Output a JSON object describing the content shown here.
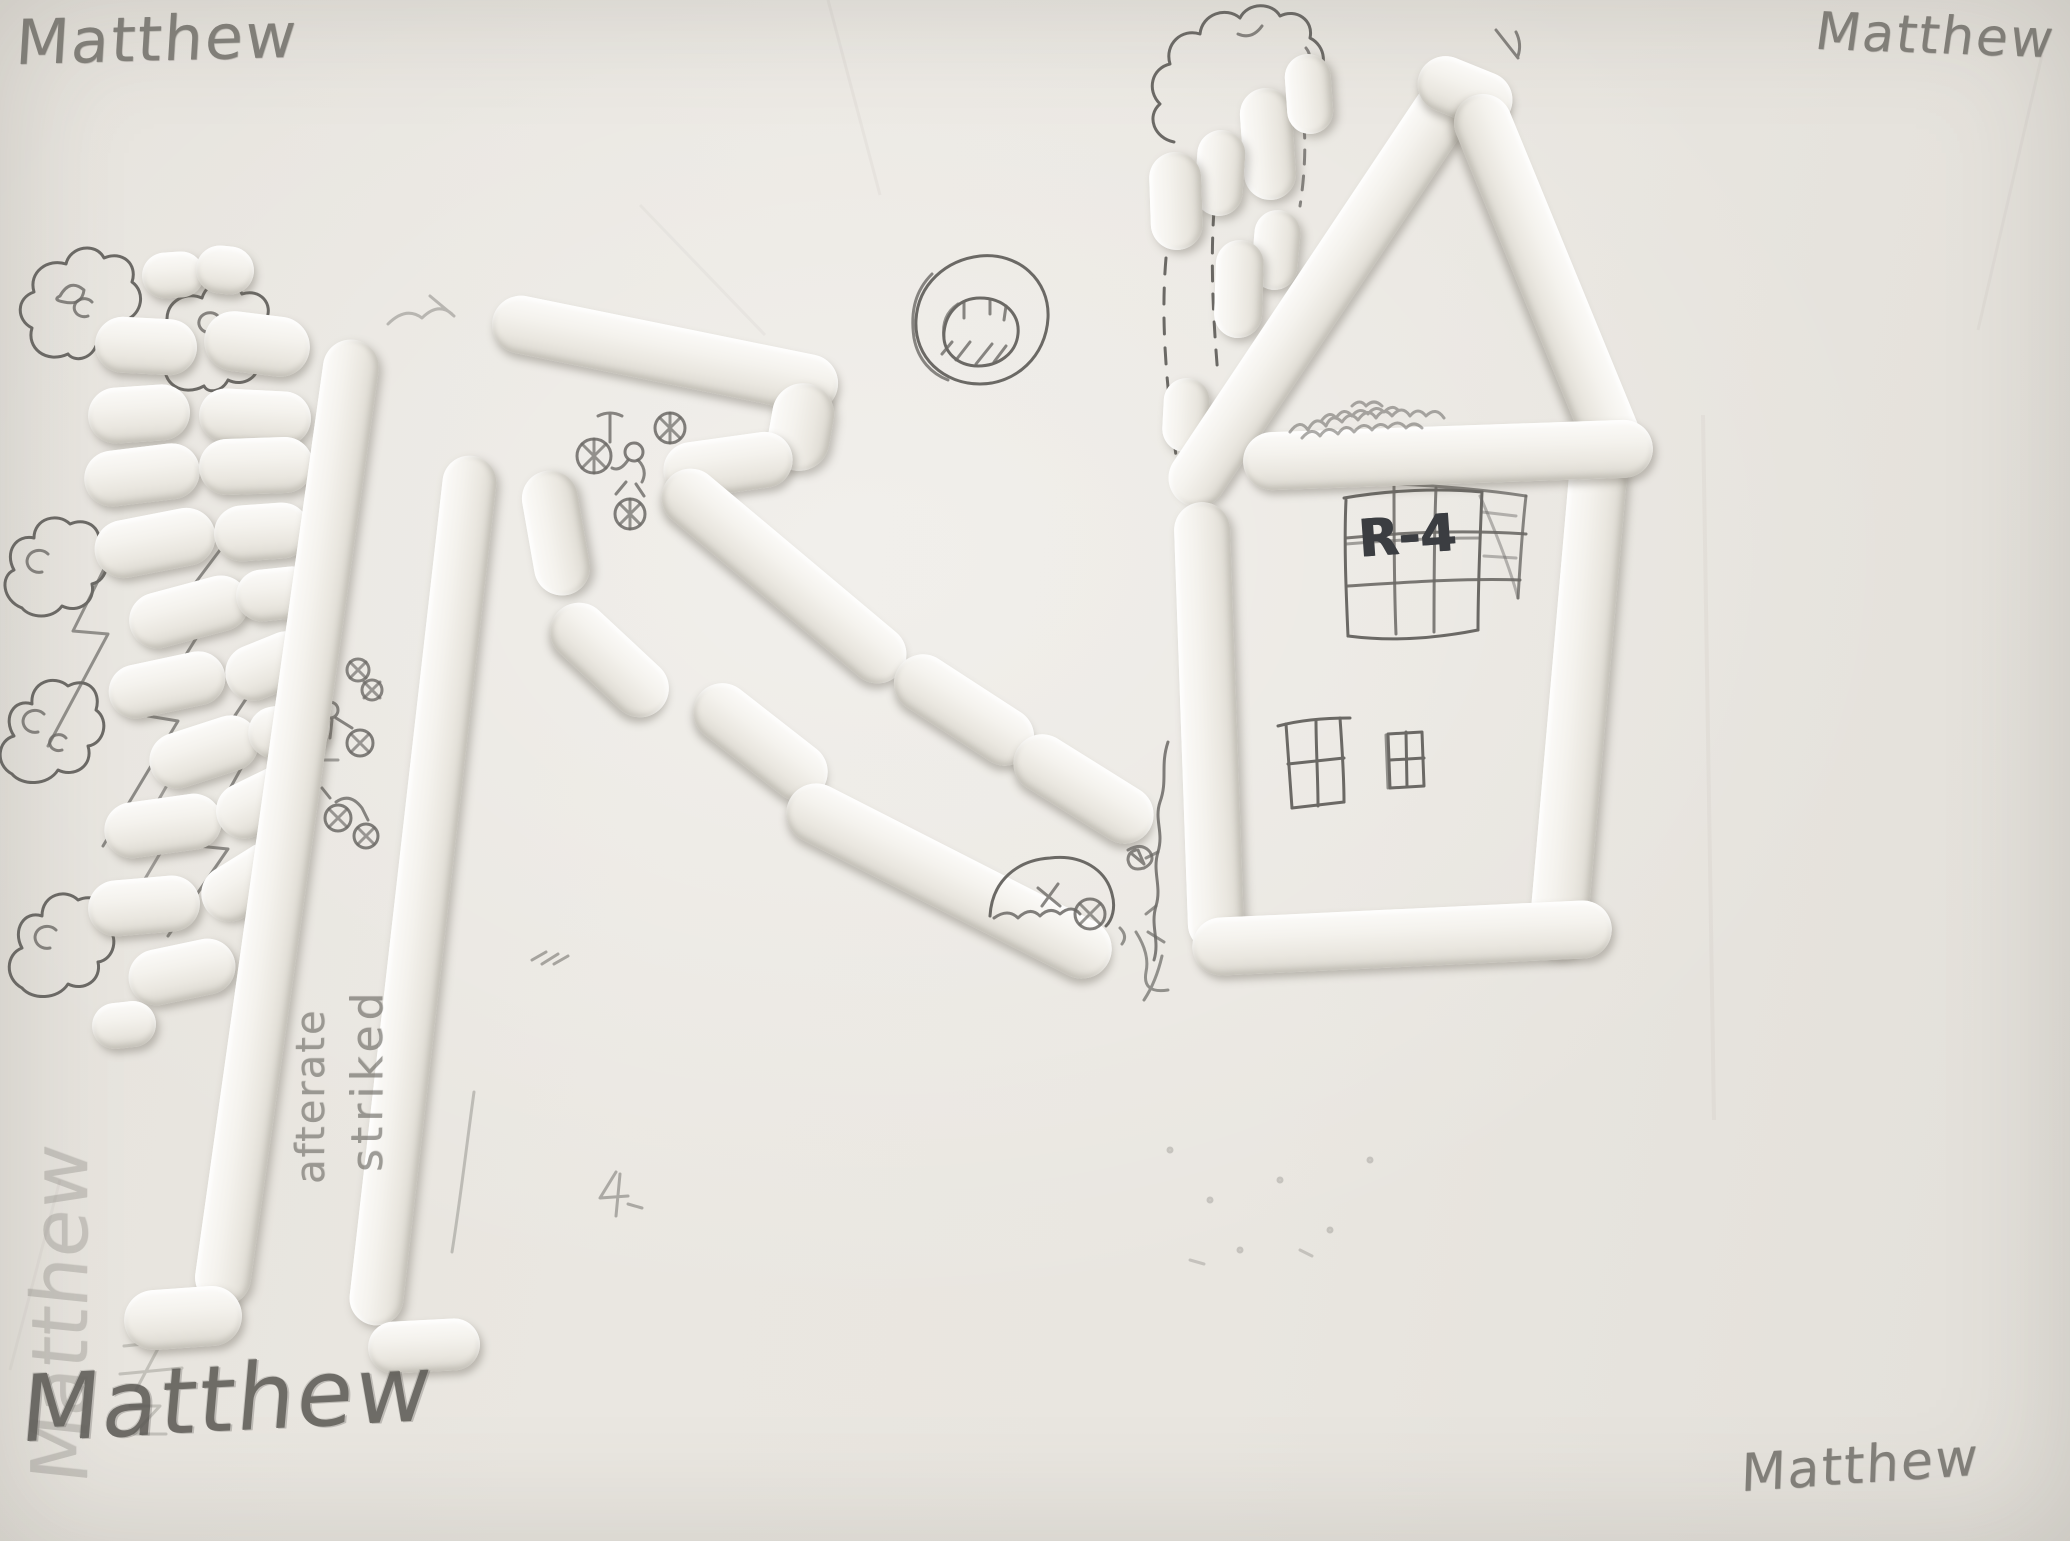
{
  "signatures": {
    "top_left": "Matthew",
    "top_right": "Matthew",
    "bottom_left": "Matthew",
    "bottom_right": "Matthew",
    "left_vertical": "Matthew"
  },
  "notes": {
    "vertical_word_1": "afterate",
    "vertical_word_2": "striked"
  },
  "house": {
    "label": "R-4"
  },
  "colors": {
    "paper": "#e9e6e0",
    "tube_highlight": "#fcfbf9",
    "tube_shadow": "#d9d6ce",
    "pencil": "#6b6965",
    "marker_text": "#3b3d41"
  }
}
